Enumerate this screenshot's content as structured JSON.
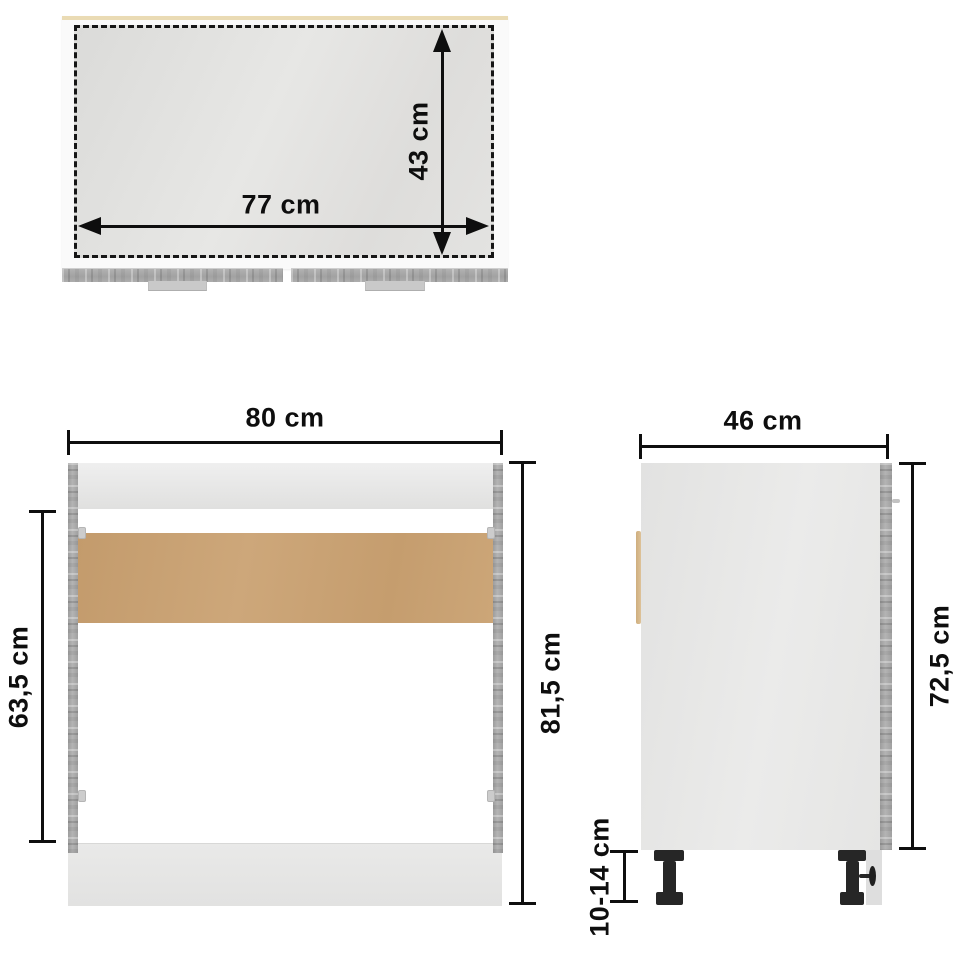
{
  "diagram_type": "furniture-dimension-diagram",
  "unit": "cm",
  "views": {
    "top": {
      "name": "top view",
      "width": "77 cm",
      "depth": "43 cm"
    },
    "front": {
      "name": "front view",
      "width": "80 cm",
      "opening_height": "63,5 cm",
      "total_height": "81,5 cm"
    },
    "side": {
      "name": "side view",
      "depth": "46 cm",
      "body_height": "72,5 cm",
      "leg_height": "10-14 cm"
    }
  },
  "colors": {
    "background": "#ffffff",
    "dimension_ink": "#0e0e0e",
    "surface_gray": "#e3e3e1",
    "wood_gray": "#a7a7a7",
    "mdf_tan": "#c8a173",
    "handle_tan": "#d6b98e",
    "leg_black": "#262626",
    "countertop_edge_cream": "#eadbb4"
  }
}
